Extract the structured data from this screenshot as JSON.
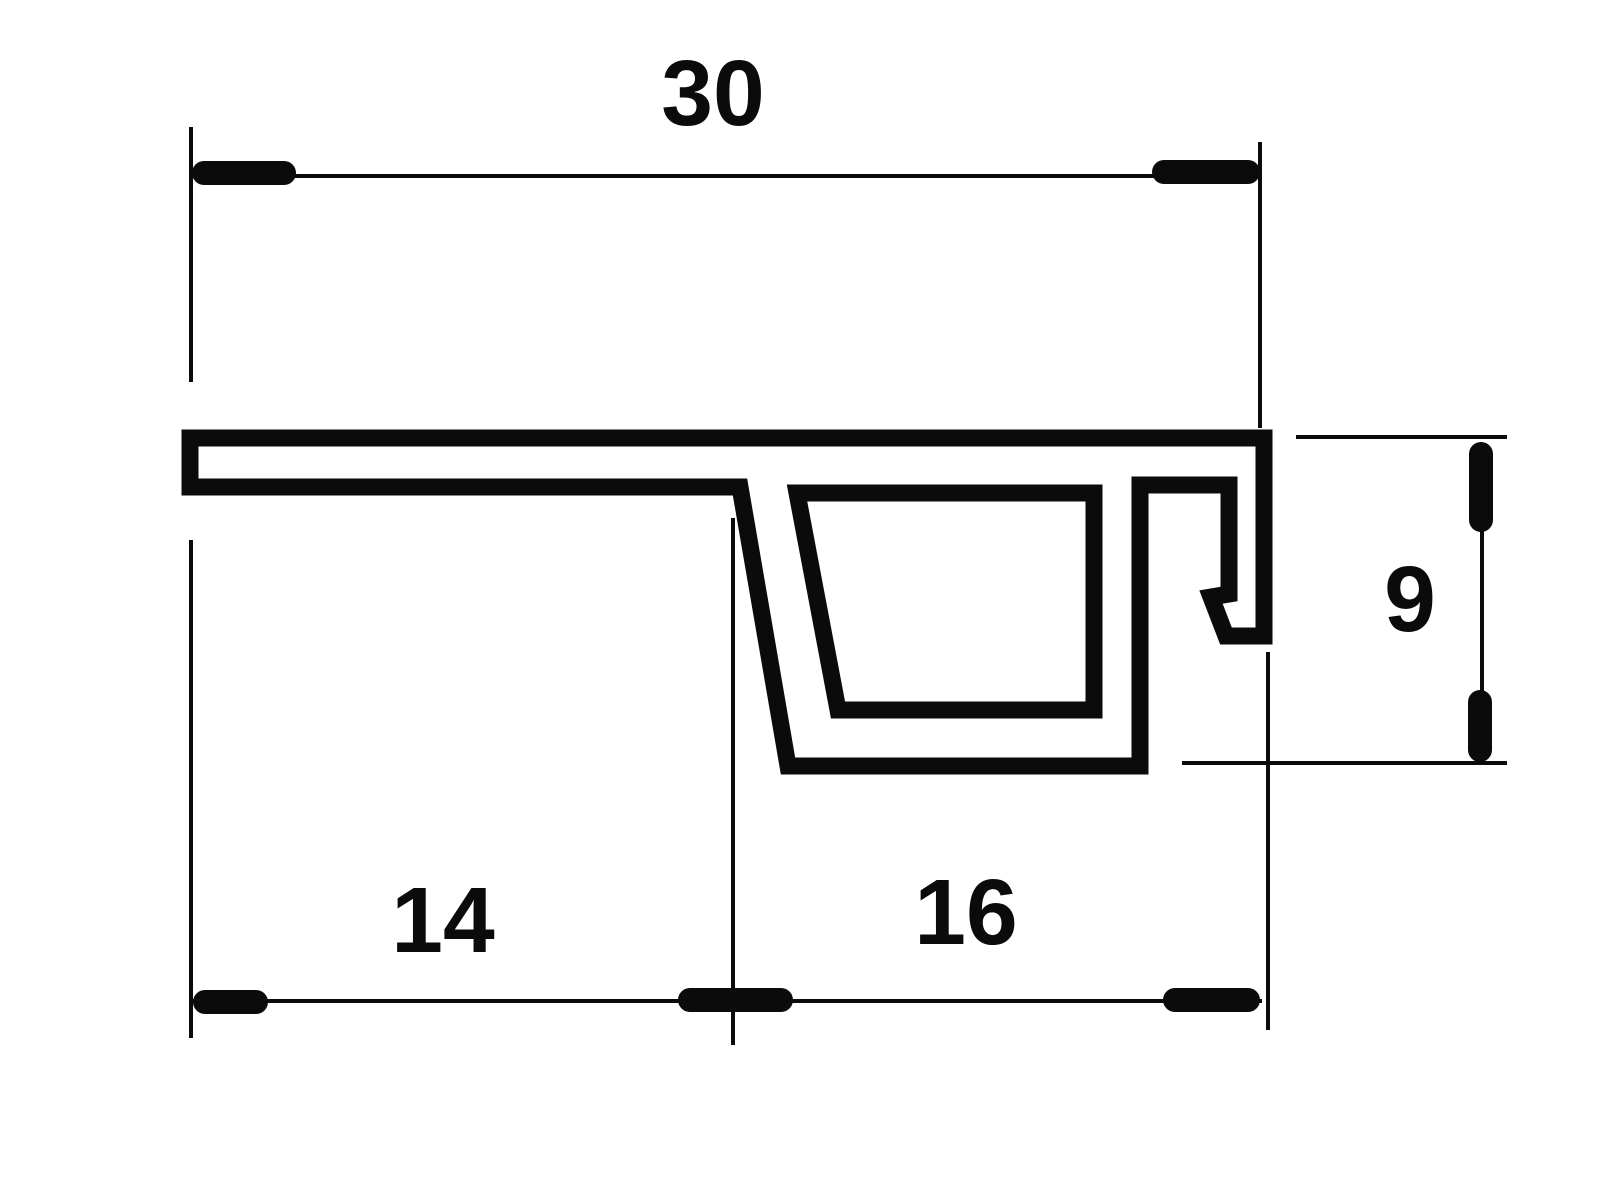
{
  "drawing": {
    "kind": "profile-cross-section-technical-drawing",
    "background_color": "#ffffff",
    "line_color": "#0b0b0b",
    "dimensions": {
      "total_width": "30",
      "left_segment": "14",
      "right_segment": "16",
      "side_height": "9"
    }
  }
}
